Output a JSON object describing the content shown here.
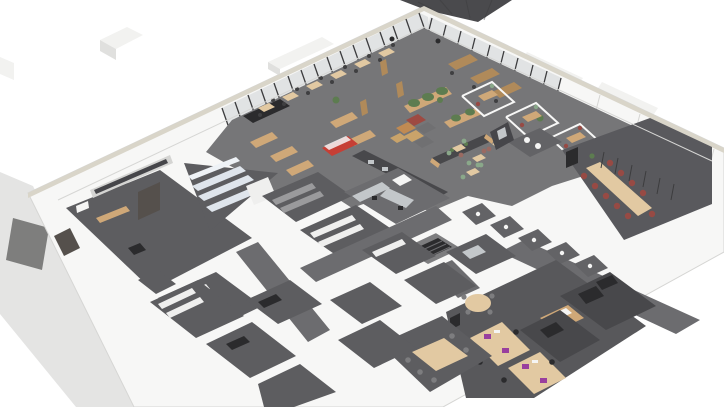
{
  "meta": {
    "title": "3D cutaway floor-plan rendering of an office / cafeteria building",
    "view": "isometric perspective from above, roof removed",
    "canvas": {
      "width": 724,
      "height": 407
    },
    "visible_text": "none"
  },
  "palette": {
    "bg": "#ffffff",
    "sidewalk": "#e4e4e3",
    "mat": "#7e7e7d",
    "ext_block": "#f2f2f0",
    "ext_shade": "#e0e0de",
    "wall": "#f7f7f6",
    "wall_edge": "#d6d6d4",
    "parapet": "#d9d5c9",
    "glass": "#cfd4d6",
    "mullion": "#3c3c3e",
    "corner_glazing": "#4a4a4d",
    "floor_open": "#767678",
    "floor_room": "#5d5d60",
    "floor_dark": "#48484b",
    "floor_corridor": "#6c6c6f",
    "floor_conference": "#59595d",
    "floor_office": "#58585b",
    "floor_booth": "#636366",
    "locker": "#dfe5ec",
    "locker_hi": "#eef2f6",
    "shelf_gray": "#9a9a9c",
    "shelf_white": "#efefee",
    "steel": "#c3c7ca",
    "wood": "#cfa878",
    "wood_light": "#e2c9a2",
    "wood_dark": "#b08a5a",
    "black_furniture": "#2b2b2d",
    "green_chair": "#8aa88a",
    "green_plant": "#5d7c50",
    "red_chair": "#974a44",
    "mauve_chair": "#9a6a62",
    "orange_sofa": "#c08a52",
    "red_sofa": "#9e4a42",
    "gray_sofa": "#707072",
    "tan_sofa": "#c9a36a",
    "fridge_red": "#c63f35",
    "purple_screen": "#993f9e",
    "artwork_light": "#d4d4d2",
    "artwork_dark": "#46464a",
    "white_fixture": "#f5f5f4",
    "door_dark": "#55504c",
    "chair_dark": "#3f3f41",
    "chair_gray": "#7d7d7f"
  },
  "regions": [
    {
      "id": "sidewalk",
      "label": "exterior paved sidewalk with dark entrance mat (lower left)"
    },
    {
      "id": "entrance-lobby",
      "label": "entrance lobby with panoramic black-and-white artwork and wooden bench"
    },
    {
      "id": "locker-room",
      "label": "triangular locker room with rows of white lockers"
    },
    {
      "id": "storage-rooms",
      "label": "storage rooms with gray and white shelving racks"
    },
    {
      "id": "commercial-kitchen",
      "label": "commercial kitchen with stainless-steel equipment"
    },
    {
      "id": "open-cafeteria",
      "label": "open cafeteria behind glass curtain walls, wooden tables, green chairs, planters"
    },
    {
      "id": "lounge-cubes",
      "label": "lounge corner with modular cube sofas (orange, red, gray, tan)"
    },
    {
      "id": "retail-displays",
      "label": "wooden display racks, black sideboard and red display fridge along north-west glass"
    },
    {
      "id": "servery",
      "label": "dark servery / barista counter with coffee machines"
    },
    {
      "id": "focus-rooms",
      "label": "glass focus rooms along north-east wall"
    },
    {
      "id": "conference-room",
      "label": "large conference room with long wooden table, dark-red chairs and wall screen"
    },
    {
      "id": "booth-row",
      "label": "row of small WC / phone booths with white fixtures"
    },
    {
      "id": "restroom",
      "label": "washroom with round mirrors and dark media wall"
    },
    {
      "id": "office-room",
      "label": "office with wooden desk banks, purple monitor screens and round meeting table"
    },
    {
      "id": "meeting-small",
      "label": "small meeting room with wooden table"
    },
    {
      "id": "stairwell",
      "label": "stairwell opening with railing"
    },
    {
      "id": "corridors",
      "label": "gray corridors linking the room maze"
    },
    {
      "id": "technical-rooms",
      "label": "dark technical / server rooms along south-east wall"
    },
    {
      "id": "back-rooms",
      "label": "back-of-house white-walled rooms with dark gray floors"
    }
  ]
}
